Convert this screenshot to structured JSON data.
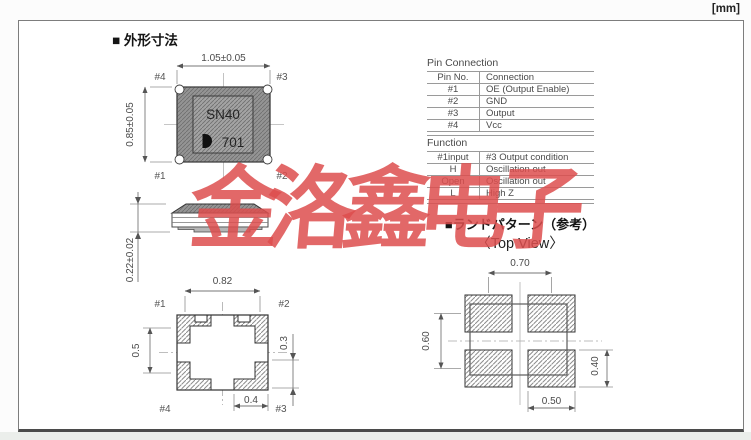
{
  "unit_label": "[mm]",
  "titles": {
    "outline": "■ 外形寸法",
    "land_pattern": "■ランドパターン（参考）",
    "top_view": "〈Top View〉"
  },
  "marking": {
    "line1": "SN40",
    "line2": "701",
    "logo_icon": "half-moon-mark"
  },
  "top_view": {
    "dim_width": "1.05±0.05",
    "dim_height": "0.85±0.05",
    "pin_tl": "#4",
    "pin_tr": "#3",
    "pin_bl": "#1",
    "pin_br": "#2"
  },
  "side_view": {
    "dim_height": "0.22±0.02"
  },
  "bottom_view": {
    "dim_span": "0.82",
    "dim_left": "0.5",
    "dim_right": "0.3",
    "dim_pad": "0.4",
    "pin_tl": "#1",
    "pin_tr": "#2",
    "pin_bl": "#4",
    "pin_br": "#3"
  },
  "land_pattern": {
    "dim_pitch_x": "0.70",
    "dim_pitch_y": "0.60",
    "dim_pad_h": "0.40",
    "dim_pad_w": "0.50"
  },
  "pin_connection": {
    "title": "Pin Connection",
    "headers": [
      "Pin No.",
      "Connection"
    ],
    "rows": [
      [
        "#1",
        "OE (Output Enable)"
      ],
      [
        "#2",
        "GND"
      ],
      [
        "#3",
        "Output"
      ],
      [
        "#4",
        "Vcc"
      ]
    ]
  },
  "function": {
    "title": "Function",
    "headers": [
      "#1input",
      "#3 Output condition"
    ],
    "rows": [
      [
        "H",
        "Oscillation out"
      ],
      [
        "Open",
        "Oscillation out"
      ],
      [
        "L",
        "High Z"
      ]
    ]
  },
  "watermark": {
    "text": "金洛鑫电子",
    "color": "#DD4D4D"
  },
  "colors": {
    "body_gray": "#949494",
    "panel_gray": "#A3A3A3",
    "outline": "#333333",
    "dim_line": "#777777"
  }
}
